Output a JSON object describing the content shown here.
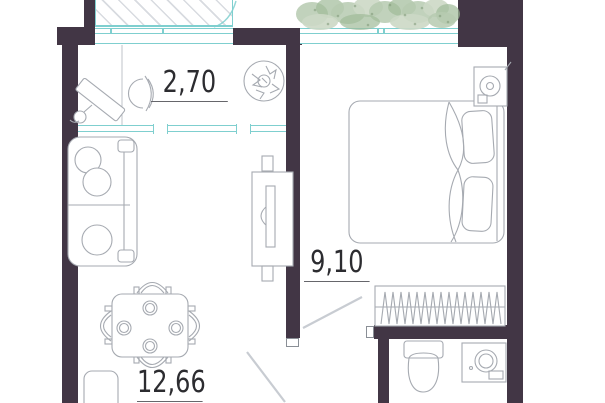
{
  "plan": {
    "type": "apartment-floor-plan",
    "rooms": [
      {
        "name": "loggia",
        "area": "2,70"
      },
      {
        "name": "bedroom",
        "area": "9,10"
      },
      {
        "name": "living-room",
        "area": "12,66"
      }
    ],
    "colors": {
      "wall": "#423645",
      "glazing": "#7fcfcf",
      "sketch": "#a6aab1",
      "hatch": "#d8dbe0",
      "label": "#2c2c30",
      "background": "#ffffff"
    },
    "furniture": {
      "loggia": [
        "desk",
        "desk-chair",
        "potted-plant"
      ],
      "bedroom": [
        "double-bed",
        "pillows",
        "water-heater",
        "wardrobe"
      ],
      "living_room": [
        "sofa",
        "dining-table",
        "dining-chairs",
        "plates",
        "tv-stand"
      ],
      "bathroom": [
        "toilet",
        "washing-machine"
      ]
    }
  }
}
